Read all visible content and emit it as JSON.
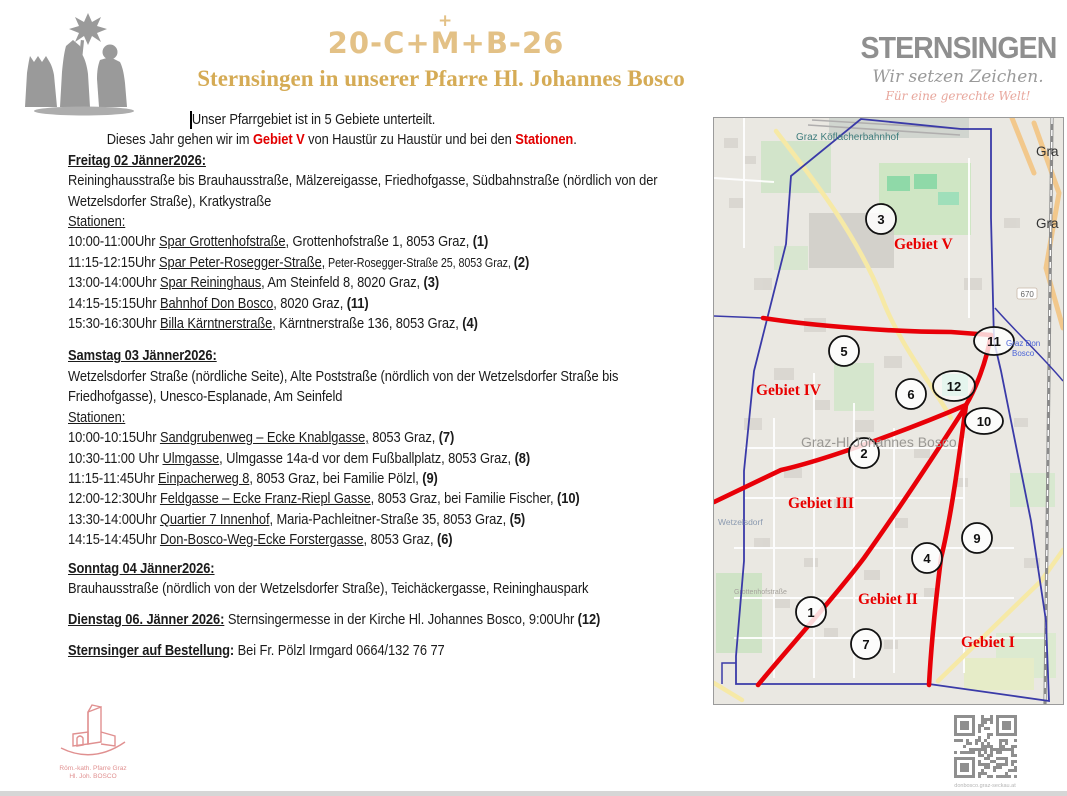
{
  "header": {
    "cmb_left": "20-C+",
    "cmb_m": "M",
    "cmb_cross": "+",
    "cmb_right": "+B-26",
    "title": "Sternsingen in unserer Pfarre Hl. Johannes Bosco",
    "brand": {
      "name": "STERNSINGEN",
      "tagline": "Wir setzen Zeichen.",
      "slogan": "Für eine gerechte Welt!"
    }
  },
  "intro": {
    "line1": "Unser Pfarrgebiet ist in 5 Gebiete unterteilt.",
    "line2_pre": "Dieses Jahr gehen wir im ",
    "line2_gebiet": "Gebiet V",
    "line2_mid": " von Haustür zu Haustür und bei den ",
    "line2_stationen": "Stationen",
    "line2_end": "."
  },
  "sections": {
    "freitag": {
      "heading": "Freitag 02 Jänner2026:",
      "streets_line1": "Reininghausstraße bis Brauhausstraße, Mälzereigasse, Friedhofgasse, Südbahnstraße (nördlich von der",
      "streets_line2": "Wetzelsdorfer Straße), Kratkystraße",
      "stationen_label": "Stationen:",
      "stations": [
        {
          "time": "10:00-11:00Uhr ",
          "place": "Spar Grottenhofstraße",
          "rest": ", Grottenhofstraße 1, 8053 Graz, ",
          "num": "(1)"
        },
        {
          "time": "11:15-12:15Uhr ",
          "place": "Spar Peter-Rosegger-Straße,",
          "rest": " Peter-Rosegger-Straße 25, 8053 Graz, ",
          "rest_small": true,
          "num": "(2)"
        },
        {
          "time": "13:00-14:00Uhr ",
          "place": "Spar Reininghaus",
          "rest": ", Am Steinfeld 8, 8020 Graz, ",
          "num": "(3)"
        },
        {
          "time": "14:15-15:15Uhr ",
          "place": "Bahnhof Don Bosco",
          "rest": ", 8020 Graz, ",
          "num": "(11)"
        },
        {
          "time": "15:30-16:30Uhr ",
          "place": "Billa Kärntnerstraße",
          "rest": ", Kärntnerstraße 136, 8053 Graz, ",
          "num": "(4)"
        }
      ]
    },
    "samstag": {
      "heading": "Samstag 03 Jänner2026:",
      "streets_line1": "Wetzelsdorfer Straße (nördliche Seite), Alte Poststraße (nördlich von der Wetzelsdorfer Straße bis",
      "streets_line2": "Friedhofgasse), Unesco-Esplanade, Am Seinfeld",
      "stationen_label": "Stationen:",
      "stations": [
        {
          "time": "10:00-10:15Uhr ",
          "place": "Sandgrubenweg – Ecke Knablgasse,",
          "rest": " 8053 Graz, ",
          "num": "(7)"
        },
        {
          "time": "10:30-11:00 Uhr ",
          "place": "Ulmgasse",
          "rest": ", Ulmgasse 14a-d vor dem Fußballplatz, 8053 Graz, ",
          "num": "(8)"
        },
        {
          "time": "11:15-11:45Uhr ",
          "place": "Einpacherweg 8",
          "rest": ", 8053 Graz, bei Familie Pölzl, ",
          "num": "(9)"
        },
        {
          "time": "12:00-12:30Uhr ",
          "place": "Feldgasse – Ecke Franz-Riepl Gasse",
          "rest": ", 8053 Graz, bei Familie Fischer, ",
          "num": "(10)"
        },
        {
          "time": "13:30-14:00Uhr ",
          "place": "Quartier 7 Innenhof",
          "rest": ", Maria-Pachleitner-Straße 35, 8053 Graz, ",
          "num": "(5)"
        },
        {
          "time": "14:15-14:45Uhr ",
          "place": "Don-Bosco-Weg-Ecke Forstergasse,",
          "rest": " 8053 Graz, ",
          "num": "(6)"
        }
      ]
    },
    "sonntag": {
      "heading": "Sonntag 04 Jänner2026:",
      "streets_line1": "Brauhausstraße (nördlich von der Wetzelsdorfer Straße), Teichäckergasse, Reininghauspark"
    },
    "dienstag": {
      "heading": "Dienstag 06. Jänner 2026:",
      "text": " Sternsingermesse in der Kirche Hl. Johannes Bosco, 9:00Uhr ",
      "num": "(12)"
    },
    "bestellung": {
      "label": "Sternsinger auf Bestellung",
      "colon": ": ",
      "text": "Bei Fr. Pölzl Irmgard 0664/132 76 77"
    }
  },
  "map": {
    "markers": [
      "3",
      "5",
      "11",
      "6",
      "12",
      "10",
      "2",
      "9",
      "4",
      "1",
      "7"
    ],
    "gebiete": {
      "g1": "Gebiet I",
      "g2": "Gebiet II",
      "g3": "Gebiet III",
      "g4": "Gebiet IV",
      "g5": "Gebiet V"
    },
    "labels": {
      "bahnhof": "Graz Köflacherbahnhof",
      "parish": "Graz-Hl.Johannes Bosco",
      "wetzelsdorf": "Wetzelsdorf",
      "station_blue_1": "Graz Don",
      "station_blue_2": "Bosco",
      "street_grottenhof": "Grottenhofstraße",
      "road_ref": "670",
      "edge_label_1": "Gra",
      "edge_label_2": "Gra"
    }
  },
  "footer": {
    "parish_logo_line1": "Röm.-kath. Pfarre Graz",
    "parish_logo_line2": "Hl. Joh. BOSCO",
    "qr_caption": "donbosco.graz-seckau.at"
  }
}
